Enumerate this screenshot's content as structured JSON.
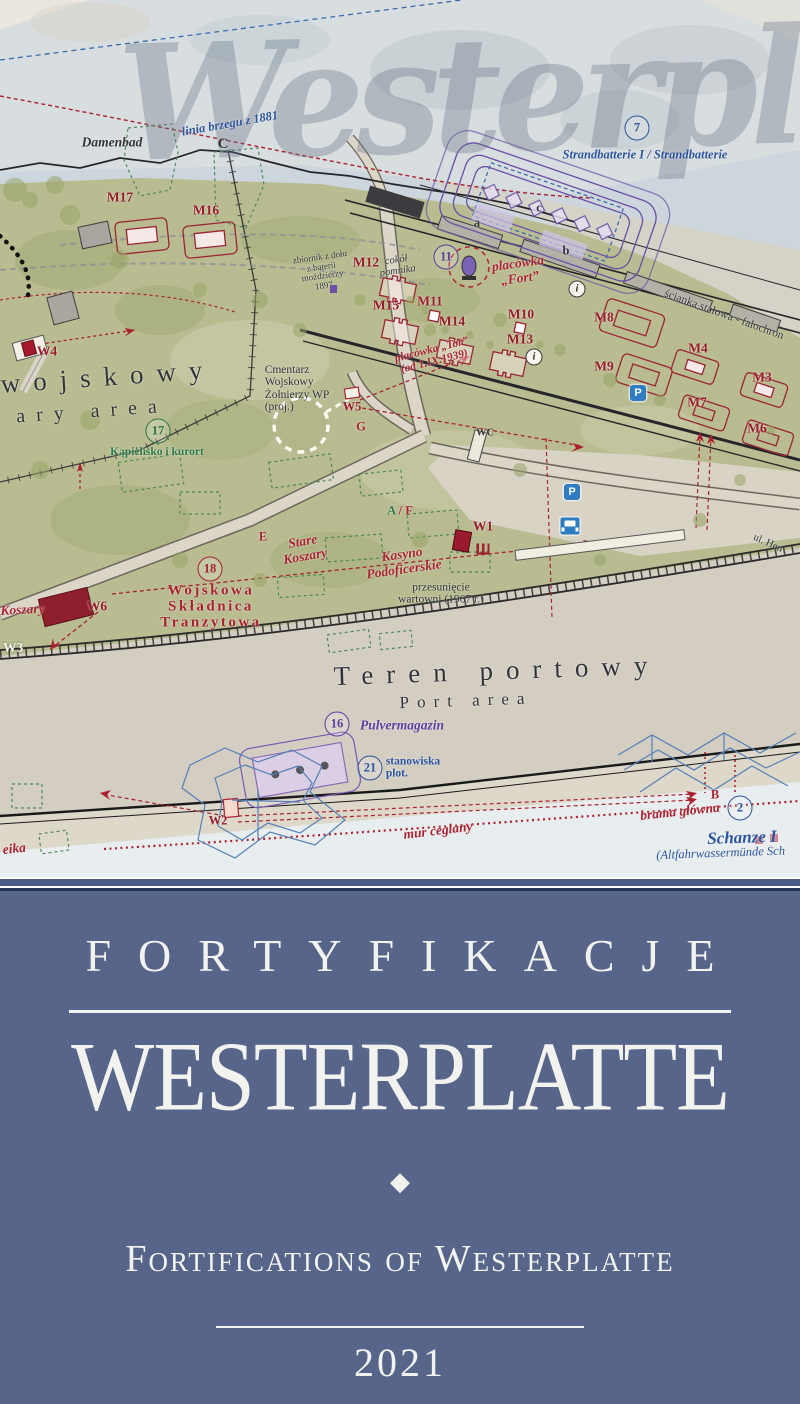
{
  "map": {
    "watermark": "Westerplatte",
    "colors": {
      "land": "#b8bc90",
      "sea": "#ccd6dc",
      "port_area": "#d3cdc2",
      "label_red": "#a82333",
      "label_dark_red": "#971c2d",
      "label_navy": "#2b55a0",
      "label_purple": "#5d3da0",
      "label_green": "#2e7a48",
      "label_dark": "#33333b",
      "parking_blue": "#2e7cc2"
    },
    "labels": {
      "linia_brzegu": "linia brzegu z 1881",
      "damenbad": "Damenbad",
      "point_c": "C",
      "marker_7": "7",
      "strandbatterie": "Strandbatterie I / Strandbatterie",
      "m17": "M17",
      "m16": "M16",
      "m12": "M12",
      "m15": "M15",
      "m11": "M11",
      "m14": "M14",
      "m10": "M10",
      "m13": "M13",
      "m8": "M8",
      "m9": "M9",
      "m4": "M4",
      "m3": "M3",
      "m7": "M7",
      "m6": "M6",
      "zbiornik_l1": "zbiornik z dołu",
      "zbiornik_l2": "z baterii",
      "zbiornik_l3": "moździerzy",
      "zbiornik_l4": "1897",
      "cokol_l1": "cokół",
      "cokol_l2": "pomnika",
      "marker_11": "11",
      "placowka_fort_l1": "placówka",
      "placowka_fort_l2": "„Fort”",
      "point_a": "a",
      "point_b": "b",
      "point_c_small": "c",
      "placowka_tor_l1": "placówka „Tor”",
      "placowka_tor_l2": "(od 1.IX.1939)",
      "scianka": "ścianka stalowa - falochron",
      "parking": "P",
      "info": "i",
      "w1": "W1",
      "w2": "W2",
      "w3": "W3",
      "w4": "W4",
      "w5": "W5",
      "w6": "W6",
      "wojskowy": "wojskowy",
      "ary_area": "ary area",
      "marker_17": "17",
      "kapielisko": "Kąpielisko i kurort",
      "cmentarz_l1": "Cmentarz",
      "cmentarz_l2": "Wojskowy",
      "cmentarz_l3": "Żołnierzy WP",
      "cmentarz_l4": "(proj.)",
      "point_g": "G",
      "wc": "WC",
      "point_a2": "A",
      "slash": "/",
      "point_f": "F",
      "point_e": "E",
      "stare_l1": "Stare",
      "stare_l2": "Koszary",
      "kasyno_l1": "Kasyno",
      "kasyno_l2": "Podoficerskie",
      "przesuniecie_l1": "przesunięcie",
      "przesuniecie_l2": "wartowni (1967 r.)",
      "koszary": "Koszary",
      "marker_18": "18",
      "skladnica_l1": "Wojskowa",
      "skladnica_l2": "Składnica",
      "skladnica_l3": "Tranzytowa",
      "teren_portowy": "Teren portowy",
      "port_area": "Port area",
      "marker_16": "16",
      "pulvermagazin": "Pulvermagazin",
      "marker_21": "21",
      "stanowiska_l1": "stanowiska",
      "stanowiska_l2": "plot.",
      "mur_ceglany": "mur ceglany",
      "point_b2": "B",
      "brama_glowna": "brama główna",
      "marker_2": "2",
      "schanze": "Schanze I",
      "altfahrwasser": "(Altfahrwassermünde Sch",
      "eika": "eika",
      "ul_he": "ul. Hen"
    }
  },
  "title_panel": {
    "series_title": "FORTYFIKACJE",
    "main_title": "WESTERPLATTE",
    "ornament": "◆",
    "subtitle": "Fortifications of Westerplatte",
    "year": "2021",
    "background": "#57658a",
    "text_color": "#f2f3ee"
  }
}
